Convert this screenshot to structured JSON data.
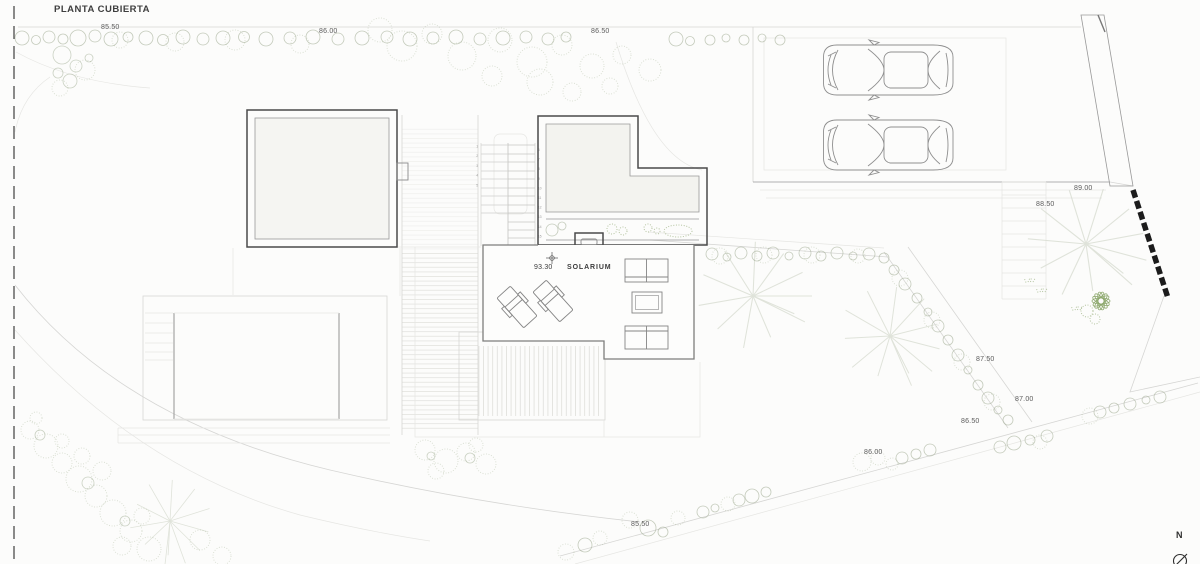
{
  "title": "PLANTA CUBIERTA",
  "compass": {
    "label": "N"
  },
  "solarium": {
    "level": "93.30",
    "label": "SOLARIUM"
  },
  "levels": {
    "top": [
      "85.50",
      "86.00",
      "86.50"
    ],
    "right": [
      "89.00",
      "88.50"
    ],
    "slope": [
      "87.50",
      "87.00",
      "86.50",
      "86.00",
      "85.50"
    ]
  },
  "stair": {
    "left_numbers": [
      "1",
      "2",
      "3",
      "4",
      "5"
    ],
    "right_numbers": [
      "6",
      "7",
      "8",
      "9",
      "10",
      "11",
      "12",
      "13",
      "14",
      "15",
      "16"
    ]
  },
  "colors": {
    "line_dark": "#4a4a4a",
    "line_faint": "#d6d6d4",
    "vegetation": "#a2ad95",
    "wall_hatch": "#1c1c1c",
    "paper": "#fcfcfb"
  }
}
